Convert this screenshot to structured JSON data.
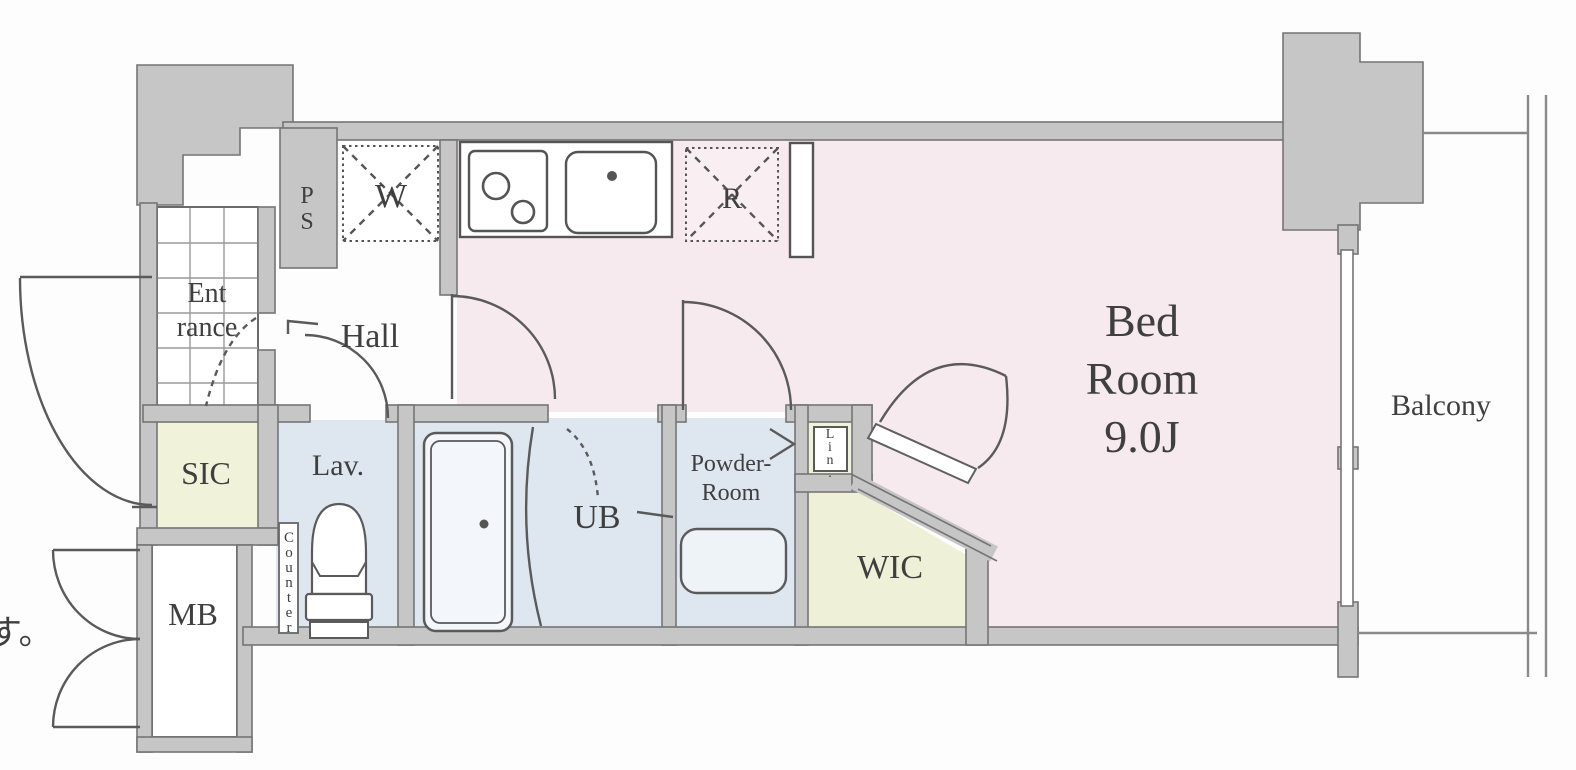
{
  "type": "apartment-floor-plan",
  "colors": {
    "room_pink": "#f6eaee",
    "room_blue": "#dee7f0",
    "room_yellow": "#f1f2da",
    "wall_gray": "#c6c6c6",
    "wall_outline": "#757575",
    "line_dark": "#4f4f4f",
    "text": "#3f3f3f"
  },
  "labels": {
    "entrance_line1": "Ent",
    "entrance_line2": "rance",
    "hall": "Hall",
    "pipe_space": "PS",
    "washer": "W",
    "refrigerator": "R",
    "shoe_closet": "SIC",
    "meter_box": "MB",
    "lavatory": "Lav.",
    "counter": "Counter",
    "unit_bath": "UB",
    "powder_line1": "Powder-",
    "powder_line2": "Room",
    "linen": "Lin.",
    "walk_in_closet": "WIC",
    "bedroom_line1": "Bed",
    "bedroom_line2": "Room",
    "bedroom_line3": "9.0J",
    "balcony": "Balcony",
    "margin_note": "す。"
  }
}
